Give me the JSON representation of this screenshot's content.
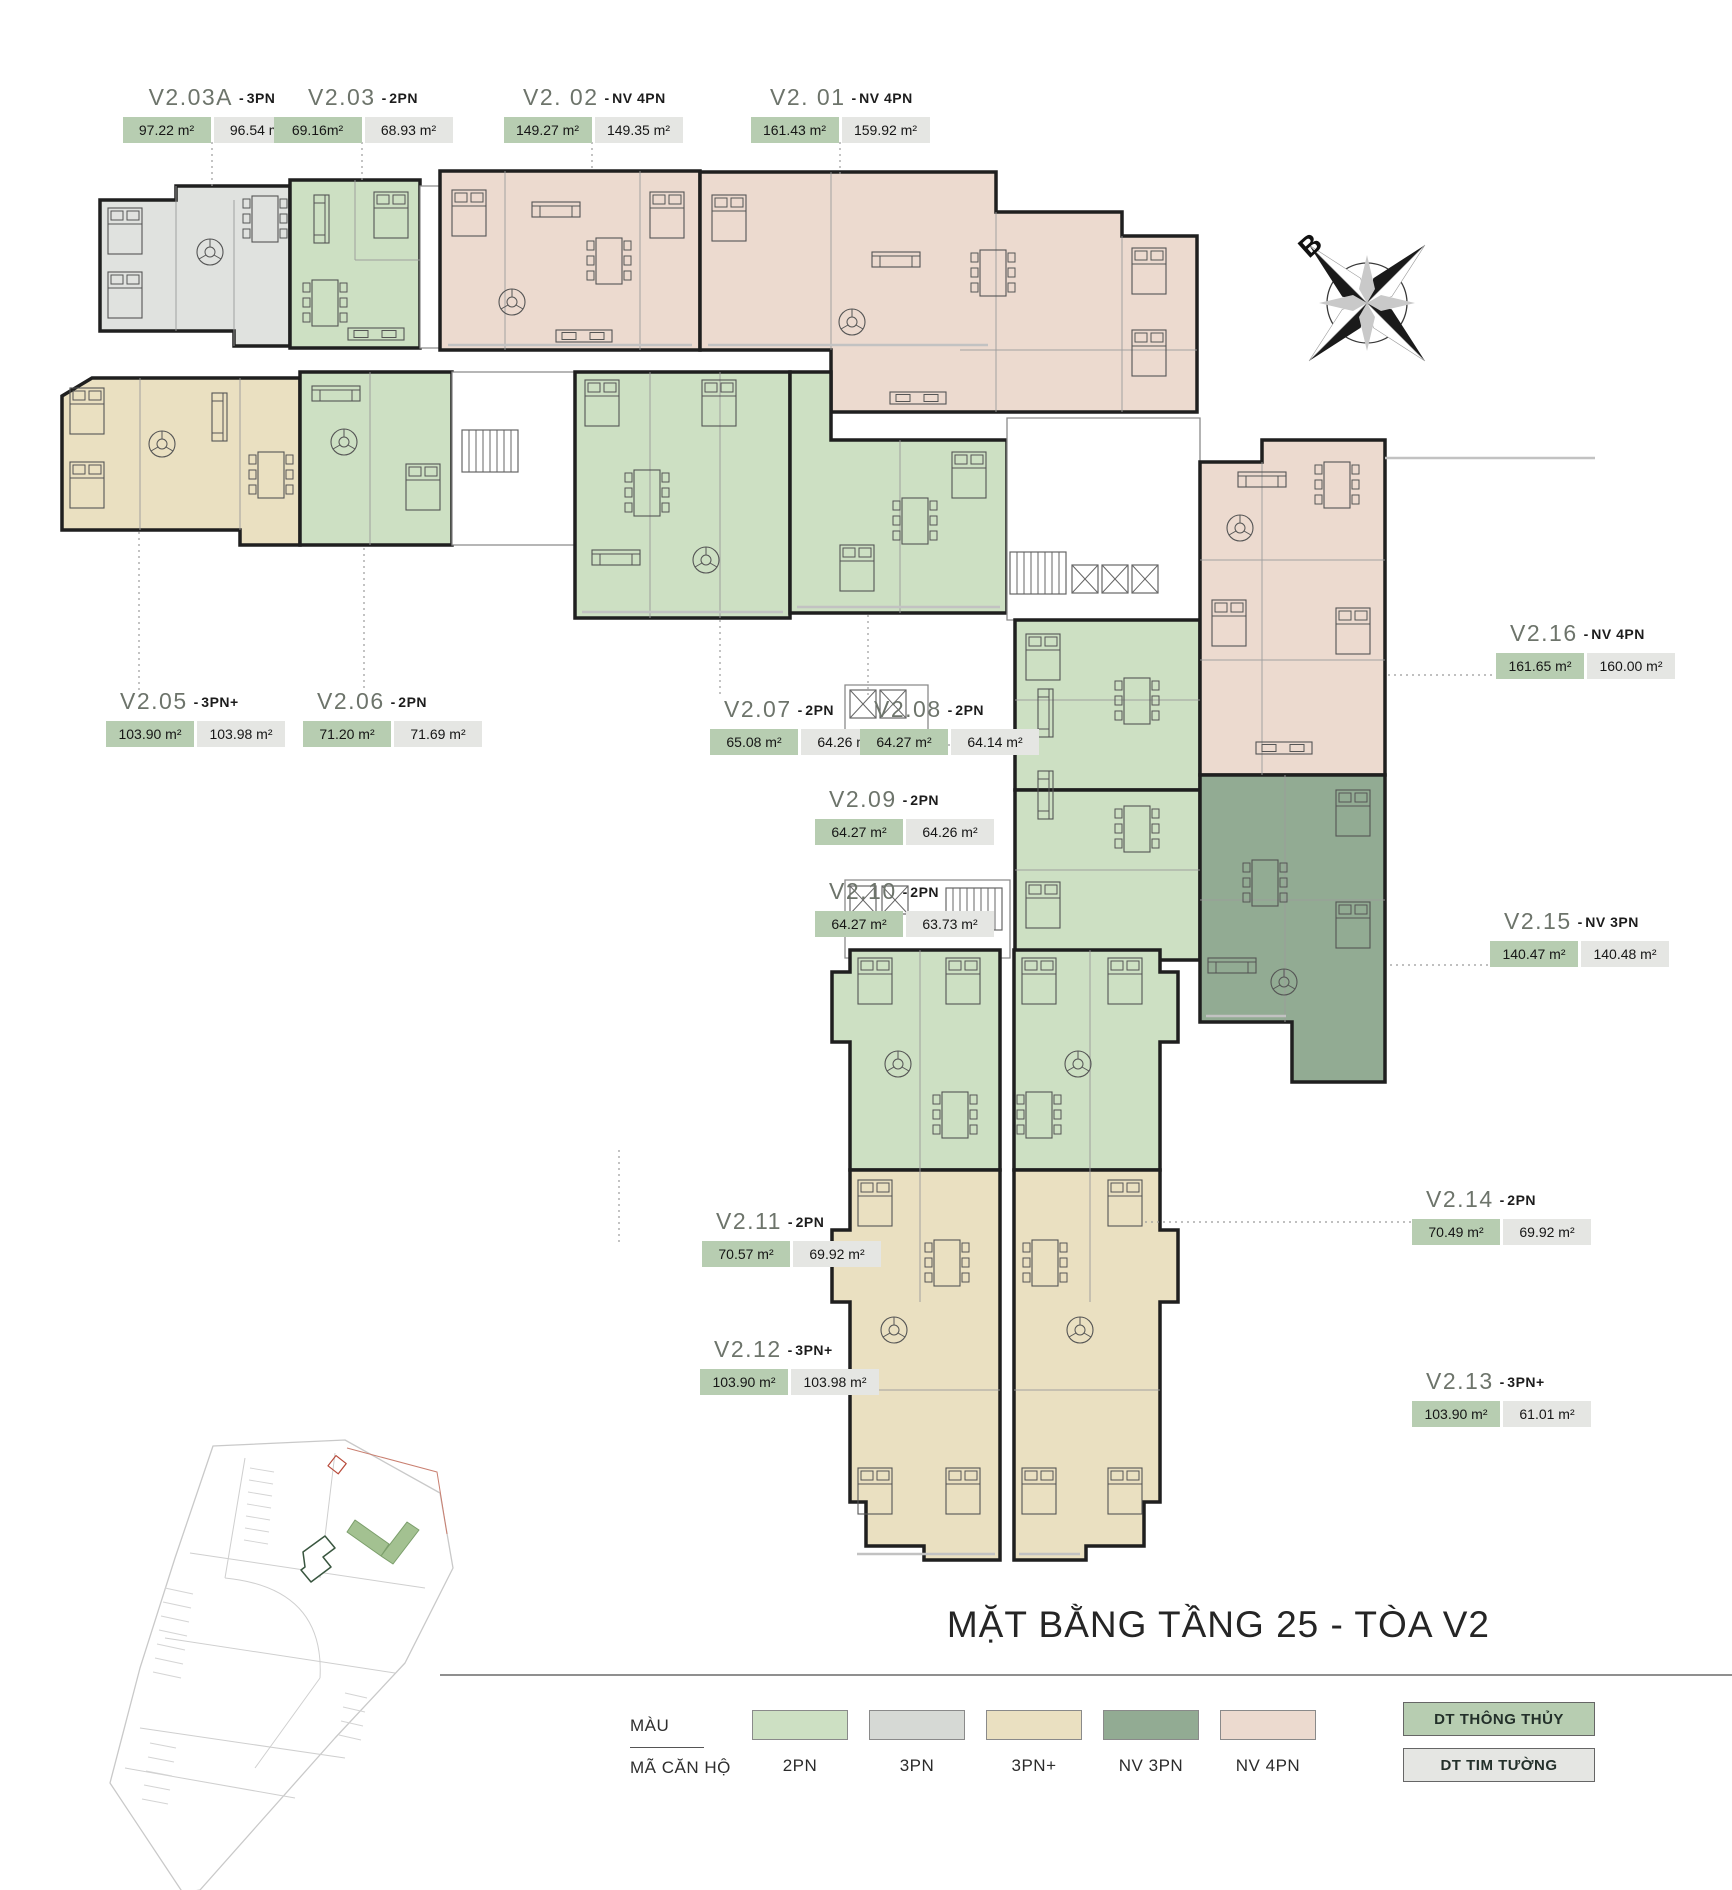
{
  "title": "MẶT BẰNG TẦNG 25 - TÒA V2",
  "compass": {
    "north_label": "B"
  },
  "sep": "-",
  "units": [
    {
      "code": "V2.03A",
      "type": "3PN",
      "area_clear": "97.22 m²",
      "area_wall": "96.54 m²"
    },
    {
      "code": "V2.03",
      "type": "2PN",
      "area_clear": "69.16m²",
      "area_wall": "68.93 m²"
    },
    {
      "code": "V2. 02",
      "type": "NV 4PN",
      "area_clear": "149.27 m²",
      "area_wall": "149.35 m²"
    },
    {
      "code": "V2. 01",
      "type": "NV 4PN",
      "area_clear": "161.43 m²",
      "area_wall": "159.92 m²"
    },
    {
      "code": "V2.05",
      "type": "3PN+",
      "area_clear": "103.90 m²",
      "area_wall": "103.98 m²"
    },
    {
      "code": "V2.06",
      "type": "2PN",
      "area_clear": "71.20 m²",
      "area_wall": "71.69 m²"
    },
    {
      "code": "V2.07",
      "type": "2PN",
      "area_clear": "65.08 m²",
      "area_wall": "64.26 m²"
    },
    {
      "code": "V2.08",
      "type": "2PN",
      "area_clear": "64.27 m²",
      "area_wall": "64.14 m²"
    },
    {
      "code": "V2.09",
      "type": "2PN",
      "area_clear": "64.27 m²",
      "area_wall": "64.26 m²"
    },
    {
      "code": "V2.10",
      "type": "2PN",
      "area_clear": "64.27 m²",
      "area_wall": "63.73 m²"
    },
    {
      "code": "V2.11",
      "type": "2PN",
      "area_clear": "70.57 m²",
      "area_wall": "69.92 m²"
    },
    {
      "code": "V2.12",
      "type": "3PN+",
      "area_clear": "103.90 m²",
      "area_wall": "103.98 m²"
    },
    {
      "code": "V2.13",
      "type": "3PN+",
      "area_clear": "103.90 m²",
      "area_wall": "61.01 m²"
    },
    {
      "code": "V2.14",
      "type": "2PN",
      "area_clear": "70.49 m²",
      "area_wall": "69.92 m²"
    },
    {
      "code": "V2.15",
      "type": "NV 3PN",
      "area_clear": "140.47 m²",
      "area_wall": "140.48 m²"
    },
    {
      "code": "V2.16",
      "type": "NV 4PN",
      "area_clear": "161.65 m²",
      "area_wall": "160.00 m²"
    }
  ],
  "legend": {
    "row1_label": "MÀU",
    "row2_label": "MÃ CĂN HỘ",
    "types": [
      {
        "label": "2PN",
        "color": "#cde0c3"
      },
      {
        "label": "3PN",
        "color": "#d6d9d5"
      },
      {
        "label": "3PN+",
        "color": "#eae0c1"
      },
      {
        "label": "NV 3PN",
        "color": "#92ab93"
      },
      {
        "label": "NV 4PN",
        "color": "#ecdacf"
      }
    ],
    "area_badges": [
      {
        "label": "DT THÔNG THỦY",
        "color": "#b7cdb1"
      },
      {
        "label": "DT TIM TƯỜNG",
        "color": "#e5e6e3"
      }
    ]
  },
  "colors": {
    "wall": "#1f1f1f",
    "unit_2pn": "#cde0c3",
    "unit_3pn": "#e0e2df",
    "unit_3pn_plus": "#eae0c1",
    "unit_nv3pn": "#92ab93",
    "unit_nv4pn": "#ecdacf",
    "badge_clear": "#b7cdb1",
    "badge_wall": "#e5e6e3"
  }
}
